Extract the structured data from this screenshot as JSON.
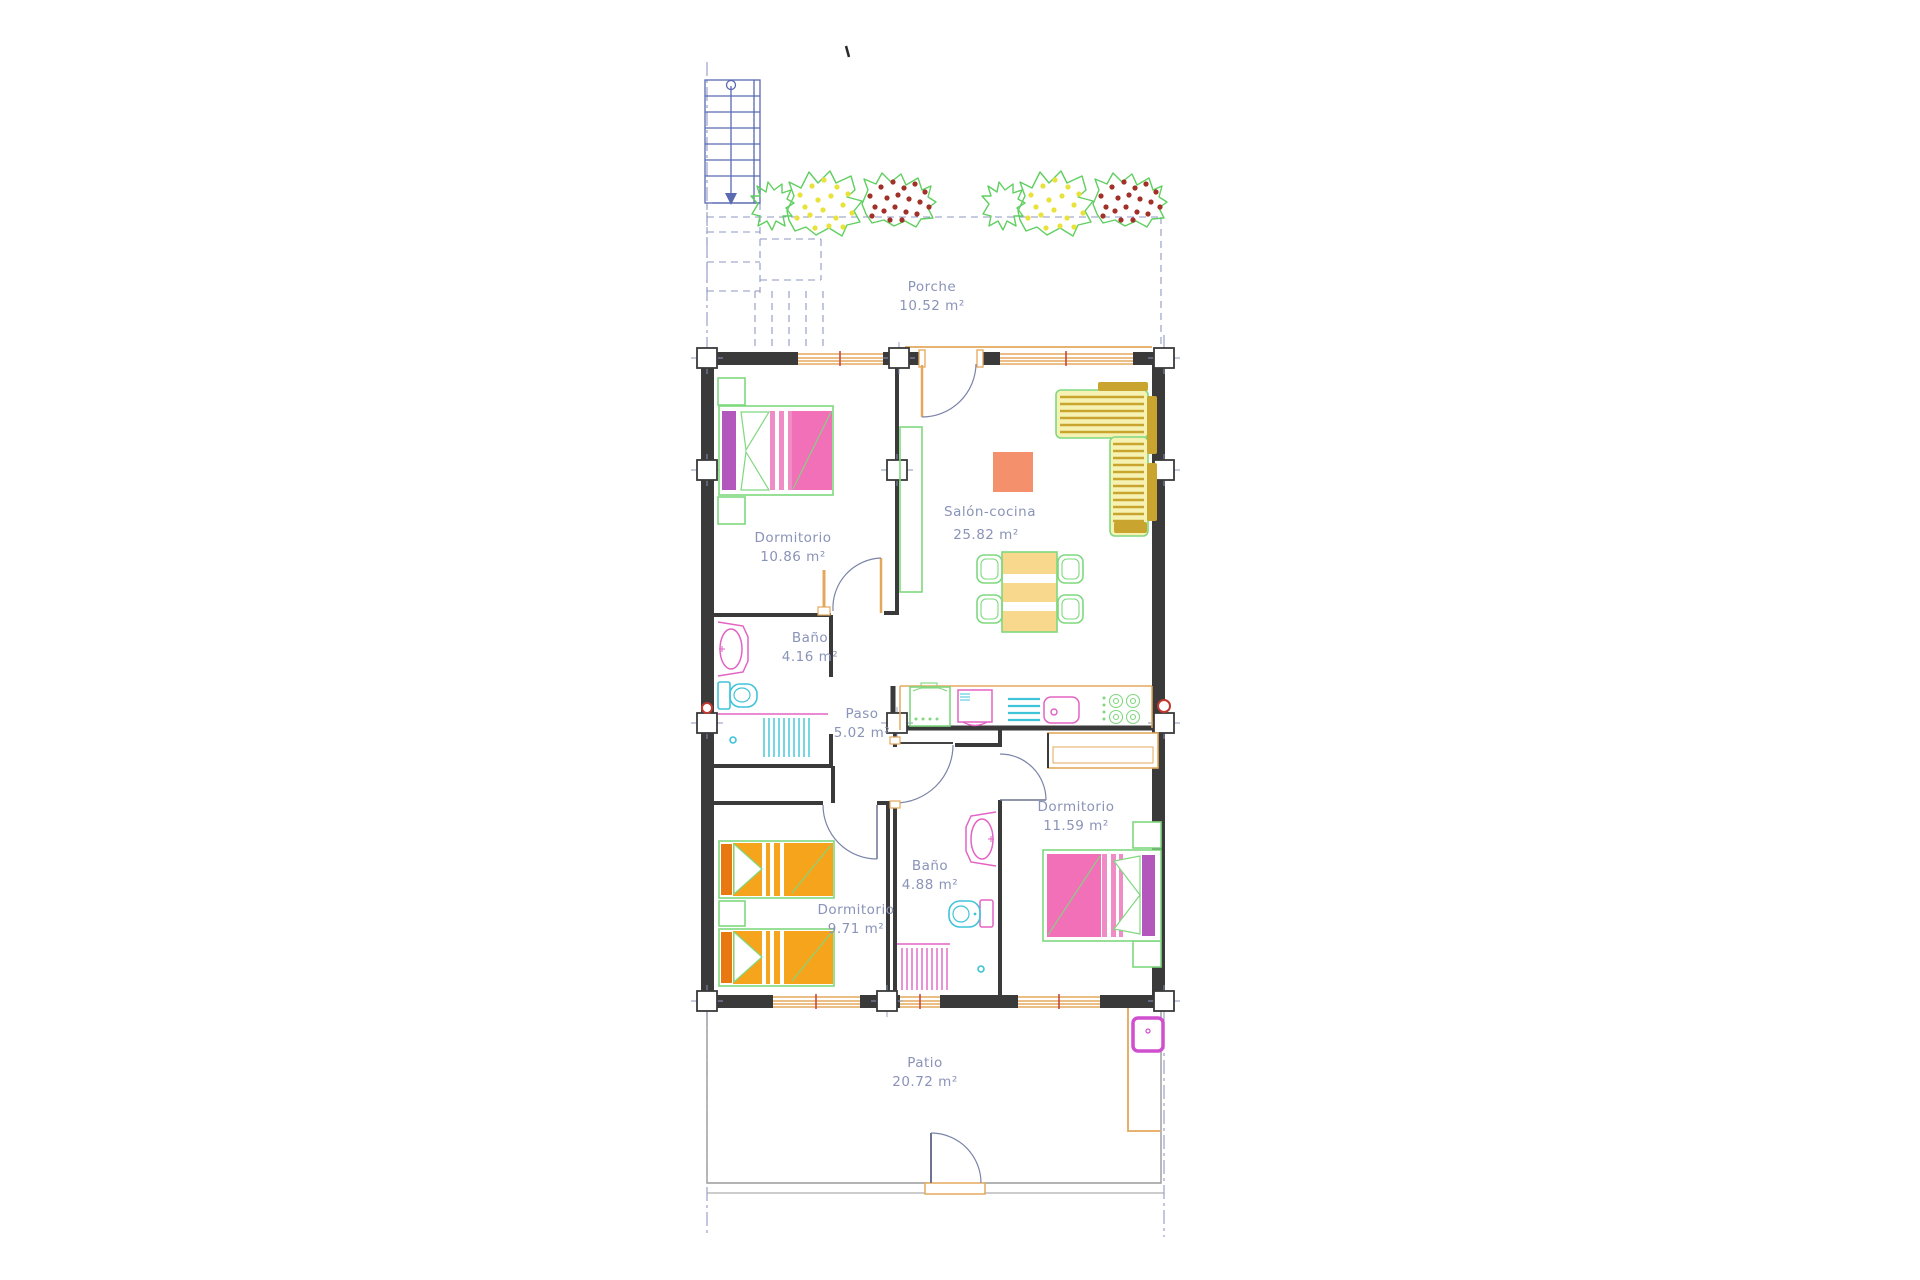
{
  "plan": {
    "type": "residential-floor-plan",
    "drawing_style": "CAD",
    "language": "es"
  },
  "rooms": {
    "porche": {
      "name": "Porche",
      "area": "10.52 m²"
    },
    "salon": {
      "name": "Salón-cocina",
      "area": "25.82 m²"
    },
    "dormitorio1": {
      "name": "Dormitorio",
      "area": "10.86 m²"
    },
    "bano1": {
      "name": "Baño",
      "area": "4.16 m²"
    },
    "paso": {
      "name": "Paso",
      "area": "5.02 m²"
    },
    "dormitorio2": {
      "name": "Dormitorio",
      "area": "11.59 m²"
    },
    "bano2": {
      "name": "Baño",
      "area": "4.88 m²"
    },
    "dormitorio3": {
      "name": "Dormitorio",
      "area": "9.71 m²"
    },
    "patio": {
      "name": "Patio",
      "area": "20.72 m²"
    }
  },
  "colors": {
    "wall": "#3a3a3a",
    "label-text": "#8a93b8",
    "axis": "#8f97c2",
    "carpentry": "#e3a85b",
    "window-tick": "#c24840",
    "furniture-green": "#7fd87f",
    "bed-pink": "#f170b8",
    "bed-stripe-pink": "#ef8cc6",
    "headboard-purple": "#b357bd",
    "twin-orange": "#f6a41c",
    "twin-headboard": "#e87812",
    "sofa-fill": "#f6f2b4",
    "sofa-stripe": "#c9a52f",
    "table-fill": "#f8d88d",
    "rug-salmon": "#f4906c",
    "fixture-pink": "#e263c4",
    "fixture-cyan": "#3fc3d8",
    "stairs-blue": "#5a6ab0",
    "plant-green": "#5fcf5f",
    "plant-yellow": "#e8e23a",
    "plant-red": "#a03028",
    "patio-magenta": "#cf4fcf",
    "boundary-gray": "#9a9a9a"
  }
}
